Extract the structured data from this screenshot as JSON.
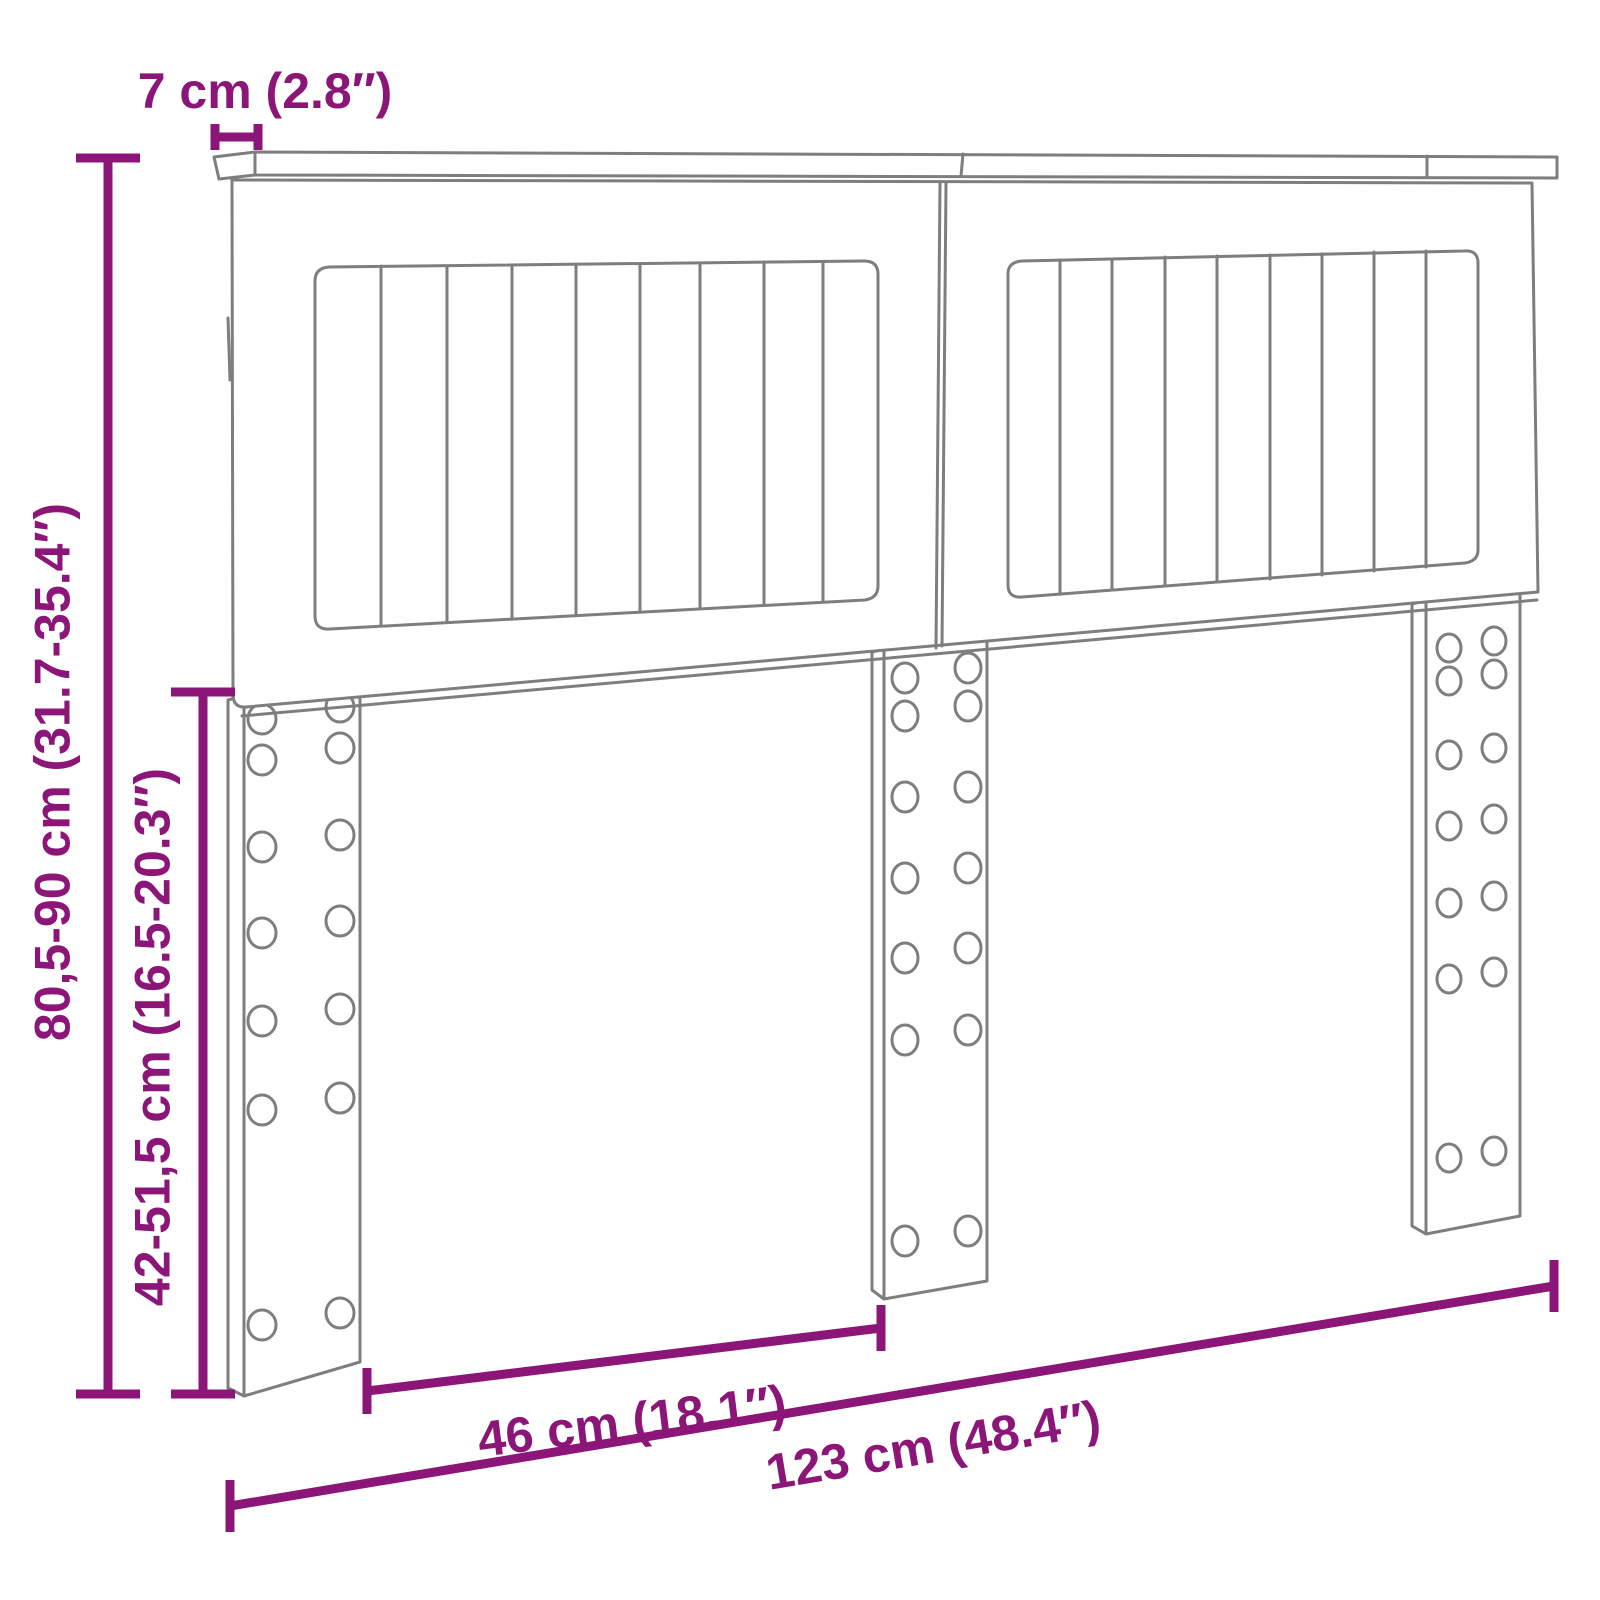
{
  "colors": {
    "dimension": "#8C1578",
    "outline": "#7E7E7E",
    "background": "#FFFFFF"
  },
  "labels": {
    "top_thickness": "7 cm (2.8″)",
    "overall_height": "80,5-90 cm (31.7-35.4″)",
    "leg_height": "42-51,5 cm (16.5-20.3″)",
    "leg_spacing": "46 cm (18.1″)",
    "overall_width": "123 cm (48.4″)"
  },
  "structure": {
    "panel_count": 2,
    "slats_per_panel": 9,
    "leg_count": 3,
    "holes_per_leg": 14
  }
}
